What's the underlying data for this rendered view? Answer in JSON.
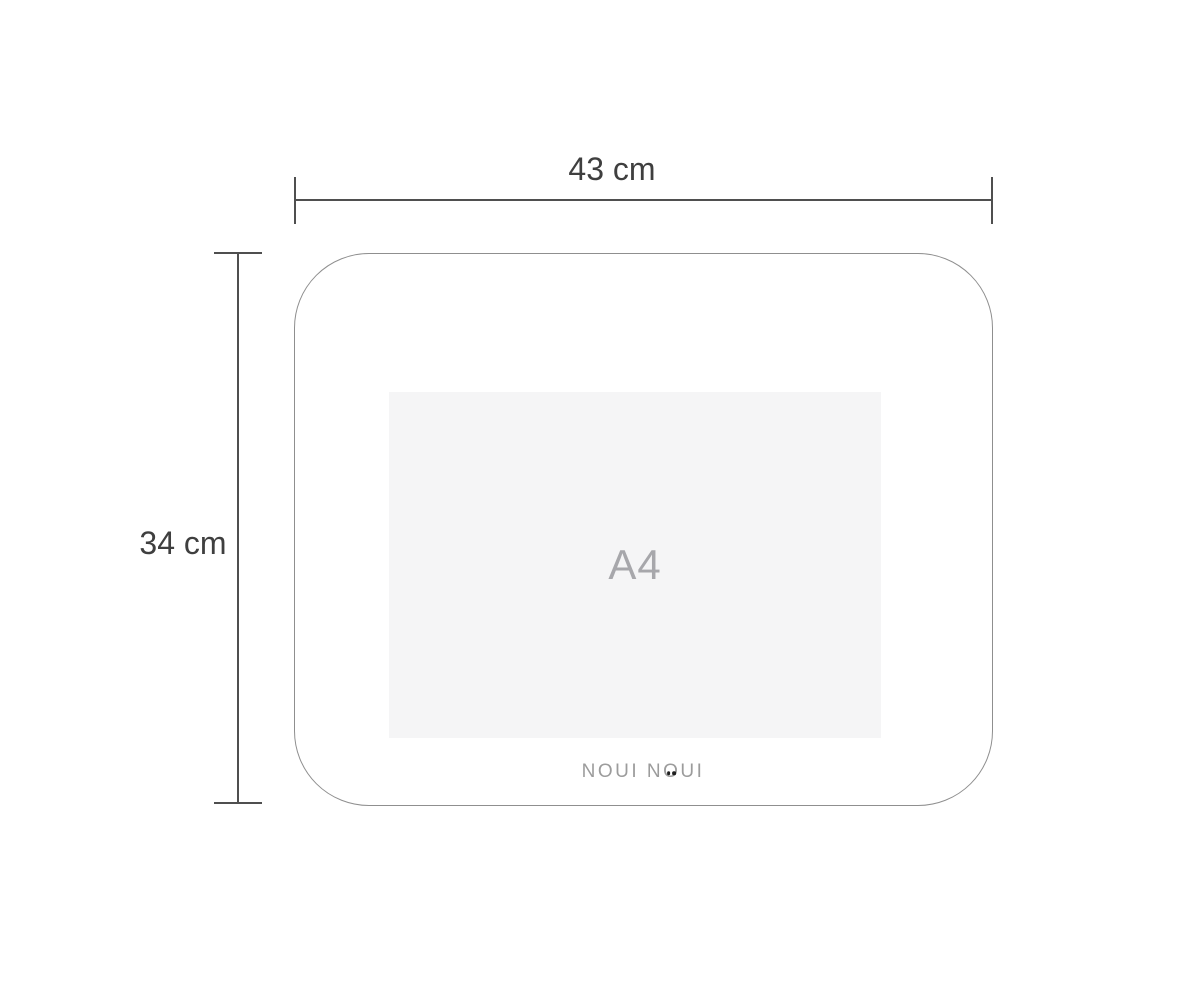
{
  "diagram": {
    "width_dimension": {
      "label": "43 cm",
      "value_cm": 43,
      "orientation": "horizontal"
    },
    "height_dimension": {
      "label": "34 cm",
      "value_cm": 34,
      "orientation": "vertical"
    },
    "inner_area": {
      "label": "A4"
    },
    "brand": {
      "name": "NOUI NOUI",
      "part_before_eye_o": "NOUI N",
      "eye_letter": "O",
      "part_after_eye_o": "UI"
    }
  },
  "colors": {
    "dimension_line": "#4f4f4f",
    "dimension_text": "#3f3f3f",
    "mat_outline": "#8f8f8f",
    "a4_fill": "#f5f5f6",
    "a4_text": "#a7a7ab",
    "brand_text": "#9c9c9c",
    "brand_eye_dot": "#1f1f1f",
    "background": "#ffffff"
  }
}
